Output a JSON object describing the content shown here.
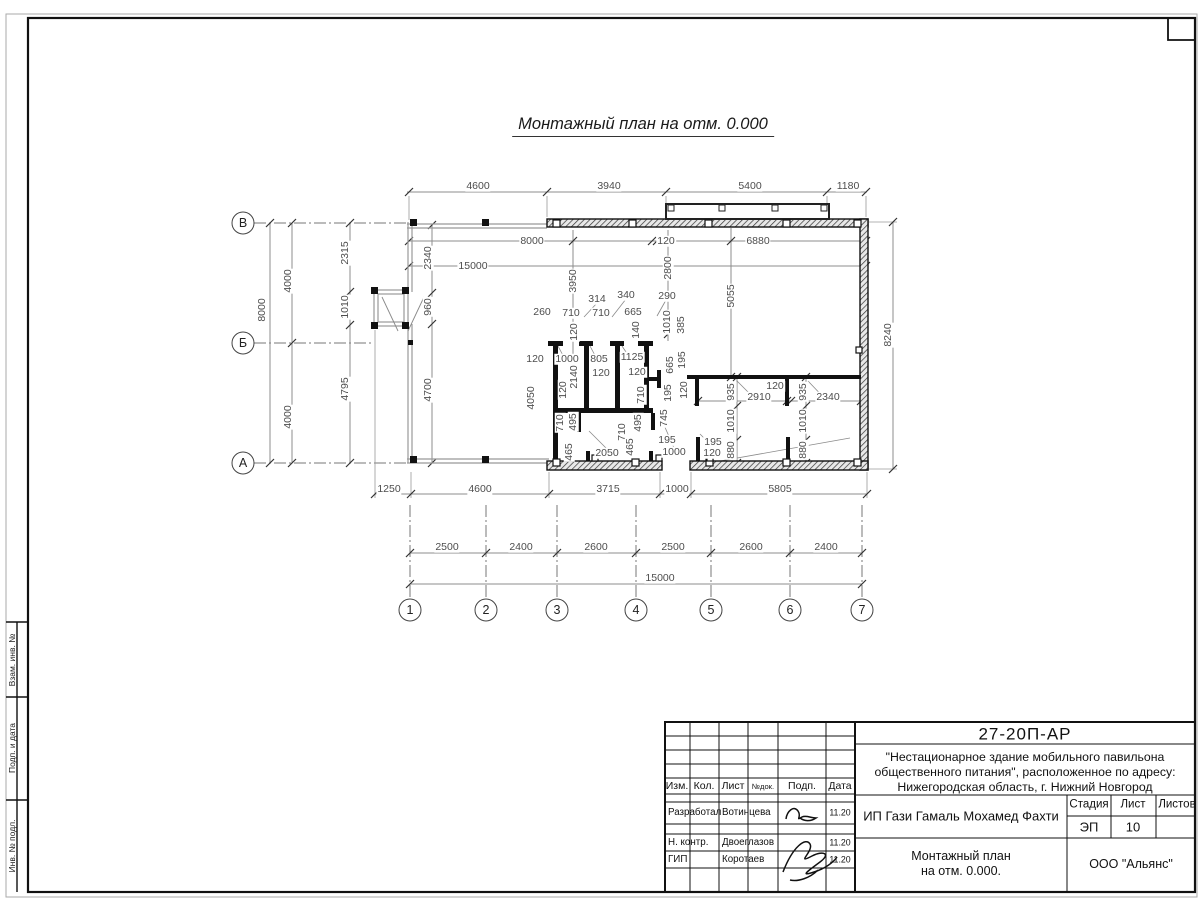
{
  "title": "Монтажный план на отм. 0.000",
  "plan": {
    "dims": [
      {
        "t": "4600",
        "x": 478,
        "y": 186
      },
      {
        "t": "3940",
        "x": 609,
        "y": 186
      },
      {
        "t": "5400",
        "x": 750,
        "y": 186
      },
      {
        "t": "1180",
        "x": 848,
        "y": 186
      },
      {
        "t": "8000",
        "x": 532,
        "y": 241
      },
      {
        "t": "120",
        "x": 666,
        "y": 241
      },
      {
        "t": "6880",
        "x": 758,
        "y": 241
      },
      {
        "t": "15000",
        "x": 473,
        "y": 266
      },
      {
        "t": "8000",
        "x": 262,
        "y": 310,
        "r": 1
      },
      {
        "t": "4000",
        "x": 288,
        "y": 281,
        "r": 1
      },
      {
        "t": "4000",
        "x": 288,
        "y": 417,
        "r": 1
      },
      {
        "t": "2315",
        "x": 345,
        "y": 253,
        "r": 1
      },
      {
        "t": "1010",
        "x": 345,
        "y": 307,
        "r": 1
      },
      {
        "t": "4795",
        "x": 345,
        "y": 389,
        "r": 1
      },
      {
        "t": "2340",
        "x": 428,
        "y": 258,
        "r": 1
      },
      {
        "t": "960",
        "x": 428,
        "y": 307,
        "r": 1
      },
      {
        "t": "4700",
        "x": 428,
        "y": 390,
        "r": 1
      },
      {
        "t": "3950",
        "x": 573,
        "y": 281,
        "r": 1
      },
      {
        "t": "2800",
        "x": 668,
        "y": 268,
        "r": 1
      },
      {
        "t": "290",
        "x": 667,
        "y": 296
      },
      {
        "t": "5055",
        "x": 731,
        "y": 296,
        "r": 1
      },
      {
        "t": "8240",
        "x": 888,
        "y": 335,
        "r": 1
      },
      {
        "t": "314",
        "x": 597,
        "y": 299
      },
      {
        "t": "340",
        "x": 626,
        "y": 295
      },
      {
        "t": "260",
        "x": 542,
        "y": 312
      },
      {
        "t": "710",
        "x": 571,
        "y": 313
      },
      {
        "t": "710",
        "x": 601,
        "y": 313
      },
      {
        "t": "665",
        "x": 633,
        "y": 312
      },
      {
        "t": "140",
        "x": 636,
        "y": 330,
        "r": 1
      },
      {
        "t": "1010",
        "x": 667,
        "y": 322,
        "r": 1
      },
      {
        "t": "385",
        "x": 681,
        "y": 325,
        "r": 1
      },
      {
        "t": "120",
        "x": 574,
        "y": 332,
        "r": 1
      },
      {
        "t": "120",
        "x": 535,
        "y": 359
      },
      {
        "t": "1000",
        "x": 567,
        "y": 359
      },
      {
        "t": "805",
        "x": 599,
        "y": 359
      },
      {
        "t": "1125",
        "x": 632,
        "y": 357
      },
      {
        "t": "665",
        "x": 670,
        "y": 365,
        "r": 1
      },
      {
        "t": "195",
        "x": 682,
        "y": 360,
        "r": 1
      },
      {
        "t": "120",
        "x": 601,
        "y": 373
      },
      {
        "t": "120",
        "x": 637,
        "y": 372
      },
      {
        "t": "2140",
        "x": 574,
        "y": 377,
        "r": 1
      },
      {
        "t": "120",
        "x": 563,
        "y": 390,
        "r": 1
      },
      {
        "t": "4050",
        "x": 531,
        "y": 398,
        "r": 1
      },
      {
        "t": "710",
        "x": 641,
        "y": 395,
        "r": 1
      },
      {
        "t": "195",
        "x": 668,
        "y": 393,
        "r": 1
      },
      {
        "t": "120",
        "x": 684,
        "y": 390,
        "r": 1
      },
      {
        "t": "935",
        "x": 731,
        "y": 392,
        "r": 1
      },
      {
        "t": "120",
        "x": 775,
        "y": 386
      },
      {
        "t": "2910",
        "x": 759,
        "y": 397
      },
      {
        "t": "935",
        "x": 803,
        "y": 392,
        "r": 1
      },
      {
        "t": "2340",
        "x": 828,
        "y": 397
      },
      {
        "t": "710",
        "x": 560,
        "y": 423,
        "r": 1
      },
      {
        "t": "495",
        "x": 573,
        "y": 422,
        "r": 1
      },
      {
        "t": "710",
        "x": 622,
        "y": 432,
        "r": 1
      },
      {
        "t": "495",
        "x": 638,
        "y": 423,
        "r": 1
      },
      {
        "t": "745",
        "x": 664,
        "y": 418,
        "r": 1
      },
      {
        "t": "1010",
        "x": 731,
        "y": 421,
        "r": 1
      },
      {
        "t": "1010",
        "x": 803,
        "y": 421,
        "r": 1
      },
      {
        "t": "465",
        "x": 569,
        "y": 452,
        "r": 1
      },
      {
        "t": "2050",
        "x": 607,
        "y": 453
      },
      {
        "t": "465",
        "x": 630,
        "y": 447,
        "r": 1
      },
      {
        "t": "195",
        "x": 667,
        "y": 440
      },
      {
        "t": "1000",
        "x": 674,
        "y": 452
      },
      {
        "t": "195",
        "x": 713,
        "y": 442
      },
      {
        "t": "120",
        "x": 712,
        "y": 453
      },
      {
        "t": "880",
        "x": 731,
        "y": 450,
        "r": 1
      },
      {
        "t": "880",
        "x": 803,
        "y": 450,
        "r": 1
      },
      {
        "t": "1250",
        "x": 389,
        "y": 489
      },
      {
        "t": "4600",
        "x": 480,
        "y": 489
      },
      {
        "t": "3715",
        "x": 608,
        "y": 489
      },
      {
        "t": "1000",
        "x": 677,
        "y": 489
      },
      {
        "t": "5805",
        "x": 780,
        "y": 489
      },
      {
        "t": "2500",
        "x": 447,
        "y": 547
      },
      {
        "t": "2400",
        "x": 521,
        "y": 547
      },
      {
        "t": "2600",
        "x": 596,
        "y": 547
      },
      {
        "t": "2500",
        "x": 673,
        "y": 547
      },
      {
        "t": "2600",
        "x": 751,
        "y": 547
      },
      {
        "t": "2400",
        "x": 826,
        "y": 547
      },
      {
        "t": "15000",
        "x": 660,
        "y": 578
      }
    ],
    "row_axes": [
      {
        "label": "В",
        "x": 243,
        "y": 223
      },
      {
        "label": "Б",
        "x": 243,
        "y": 343
      },
      {
        "label": "А",
        "x": 243,
        "y": 463
      }
    ],
    "col_axes": [
      {
        "label": "1",
        "x": 410,
        "y": 610
      },
      {
        "label": "2",
        "x": 486,
        "y": 610
      },
      {
        "label": "3",
        "x": 557,
        "y": 610
      },
      {
        "label": "4",
        "x": 636,
        "y": 610
      },
      {
        "label": "5",
        "x": 711,
        "y": 610
      },
      {
        "label": "6",
        "x": 790,
        "y": 610
      },
      {
        "label": "7",
        "x": 862,
        "y": 610
      }
    ]
  },
  "margin_labels": [
    {
      "t": "Взам. инв. №",
      "x": 12,
      "y": 660
    },
    {
      "t": "Подп. и дата",
      "x": 12,
      "y": 748
    },
    {
      "t": "Инв. № подл.",
      "x": 12,
      "y": 846
    }
  ],
  "stamp": {
    "doc_number": "27-20П-АР",
    "project_lines": [
      "\"Нестационарное здание мобильного павильона",
      "общественного питания\", расположенное по адресу:",
      "Нижегородская область, г. Нижний Новгород"
    ],
    "cols": {
      "izm": "Изм.",
      "kol": "Кол.",
      "list": "Лист",
      "ndok": "№док.",
      "podp": "Подп.",
      "data": "Дата"
    },
    "rows": [
      {
        "role": "Разработал",
        "name": "Вотинцева",
        "date": "11.20"
      },
      {
        "role": "Н. контр.",
        "name": "Двоеглазов",
        "date": "11.20"
      },
      {
        "role": "ГИП",
        "name": "Коротаев",
        "date": "11.20"
      }
    ],
    "client": "ИП Гази Гамаль Мохамед Фахти",
    "stage_label": "Стадия",
    "sheet_label": "Лист",
    "sheets_label": "Листов",
    "stage": "ЭП",
    "sheet_no": "10",
    "sheets_total": "",
    "title_lines": [
      "Монтажный план",
      "на отм. 0.000."
    ],
    "company": "ООО \"Альянс\""
  }
}
